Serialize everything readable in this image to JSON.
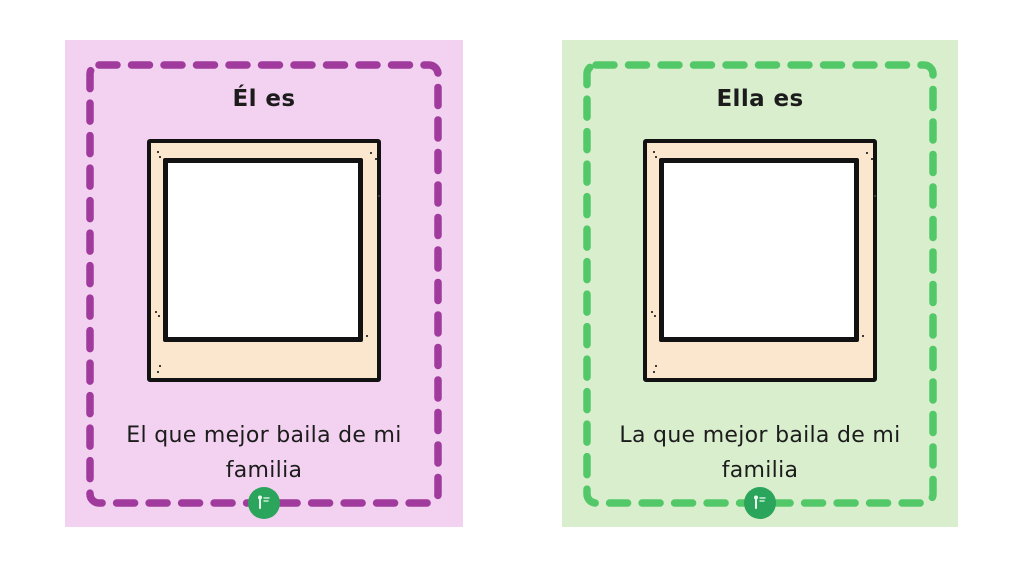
{
  "page": {
    "background_color": "#ffffff"
  },
  "cards": [
    {
      "title": "Él es",
      "caption_lines": [
        "El que mejor baila de mi",
        "familia"
      ],
      "background_color": "#f2d2f0",
      "dash_color": "#a03a9c"
    },
    {
      "title": "Ella es",
      "caption_lines": [
        "La que mejor baila de mi",
        "familia"
      ],
      "background_color": "#d8eecd",
      "dash_color": "#53c868"
    }
  ],
  "polaroid": {
    "frame_color": "#fbe7cd",
    "outline_color": "#121212",
    "photo_color": "#ffffff"
  },
  "logo": {
    "background_color": "#2ba45c"
  }
}
